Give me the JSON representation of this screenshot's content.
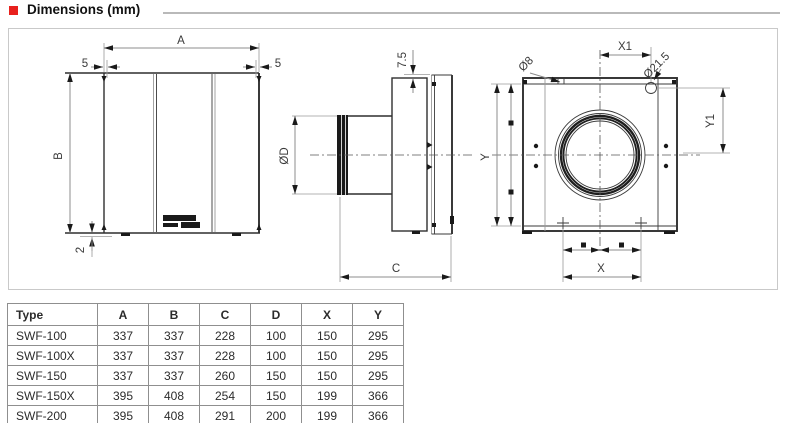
{
  "header": {
    "bullet_color": "#e8211d",
    "title": "Dimensions (mm)"
  },
  "diagram": {
    "front_view": {
      "dim_width": "A",
      "dim_height": "B",
      "dim_flange_left": "5",
      "dim_flange_right": "5",
      "dim_foot": "2"
    },
    "side_view": {
      "dim_plate_offset": "7.5",
      "dim_duct_diameter": "ØD",
      "dim_depth": "C"
    },
    "back_view": {
      "dim_hole_offset_x": "X1",
      "dim_hole_small": "Ø8",
      "dim_hole_large": "Ø21.5",
      "dim_hole_offset_y": "Y1",
      "dim_panel_height": "Y",
      "dim_hole_spacing_x": "X"
    }
  },
  "table": {
    "columns": [
      "Type",
      "A",
      "B",
      "C",
      "D",
      "X",
      "Y"
    ],
    "rows": [
      [
        "SWF-100",
        "337",
        "337",
        "228",
        "100",
        "150",
        "295"
      ],
      [
        "SWF-100X",
        "337",
        "337",
        "228",
        "100",
        "150",
        "295"
      ],
      [
        "SWF-150",
        "337",
        "337",
        "260",
        "150",
        "150",
        "295"
      ],
      [
        "SWF-150X",
        "395",
        "408",
        "254",
        "150",
        "199",
        "366"
      ],
      [
        "SWF-200",
        "395",
        "408",
        "291",
        "200",
        "199",
        "366"
      ]
    ]
  }
}
